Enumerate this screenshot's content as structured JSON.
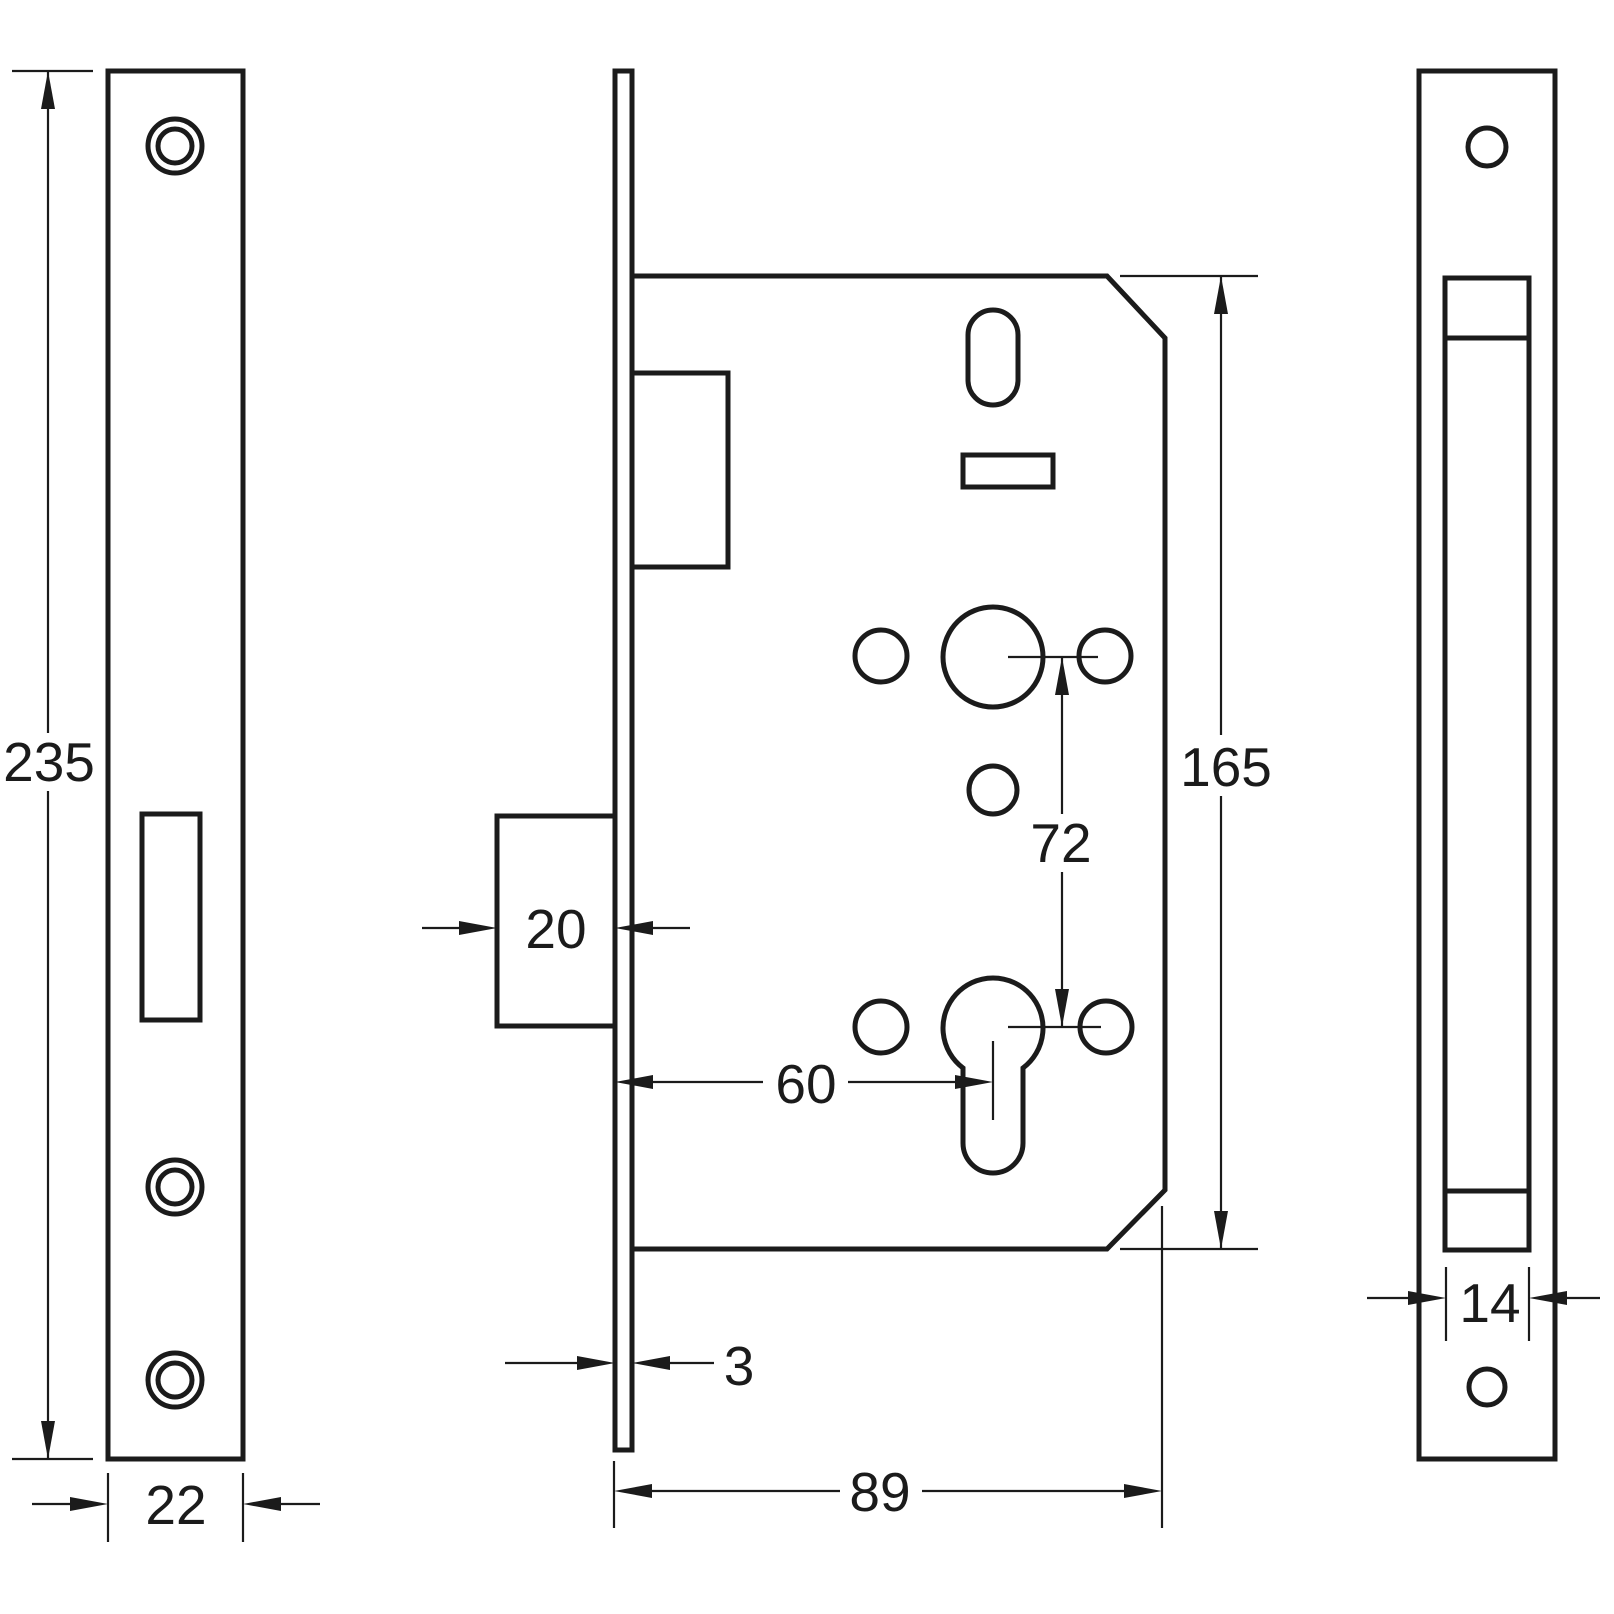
{
  "drawing": {
    "kind": "technical-drawing",
    "subject": "mortice-lock-case-and-faceplate",
    "units_implied": "mm",
    "colors": {
      "line": "#1b1b1b",
      "text": "#1b1b1b",
      "background": "#ffffff"
    },
    "views": {
      "front_plate": {
        "name": "faceplate front view",
        "dims": {
          "height": "235",
          "width": "22"
        }
      },
      "case_side": {
        "name": "lock case side view",
        "dims": {
          "bolt_throw": "20",
          "faceplate_thickness": "3",
          "backset": "60",
          "centres": "72",
          "case_height": "165",
          "case_depth": "89"
        }
      },
      "edge_plate": {
        "name": "faceplate edge view",
        "dims": {
          "case_thickness": "14"
        }
      }
    }
  }
}
